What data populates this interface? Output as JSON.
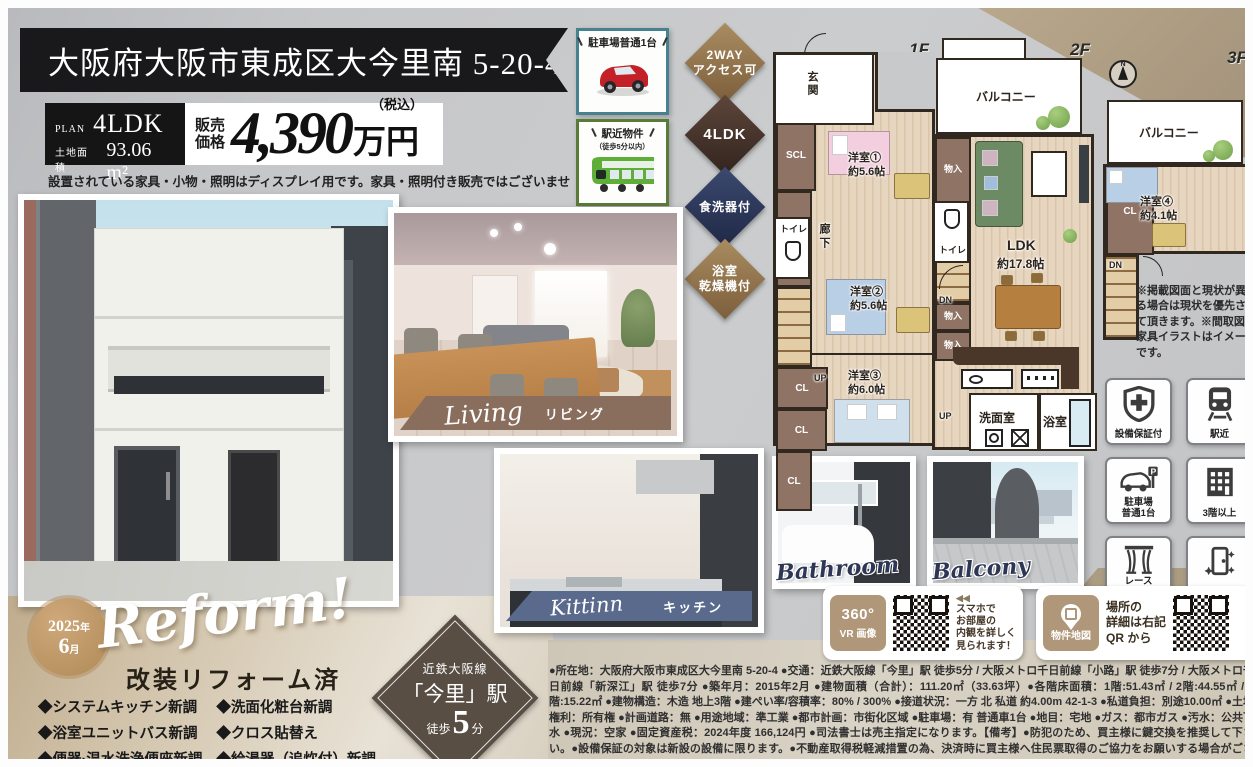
{
  "header": {
    "address": "大阪府大阪市東成区大今里南 5-20-4"
  },
  "plan_box": {
    "plan_label": "PLAN",
    "plan_value": "4LDK",
    "area_label": "土地面積",
    "area_value": "93.06 m²"
  },
  "price_box": {
    "label_line1": "販売",
    "label_line2": "価格",
    "value": "4,390",
    "unit": "万円",
    "tax_note": "（税込）"
  },
  "disclaimer": "設置されている家具・小物・照明はディスプレイ用です。家具・照明付き販売ではございません。",
  "top_badges": {
    "parking": {
      "title": "駐車場普通1台"
    },
    "station": {
      "title": "駅近物件",
      "subtitle": "（徒歩5分以内）"
    }
  },
  "diamonds": {
    "d1": {
      "line1": "2WAY",
      "line2": "アクセス可"
    },
    "d2": {
      "line1": "4LDK"
    },
    "d3": {
      "line1": "食洗器付"
    },
    "d4": {
      "line1": "浴室",
      "line2": "乾燥機付"
    }
  },
  "photo_labels": {
    "living": {
      "en": "Living",
      "jp": "リビング"
    },
    "kitchen": {
      "en": "Kittinn",
      "jp": "キッチン"
    },
    "bathroom": {
      "en": "Bathroom"
    },
    "balcony": {
      "en": "Balcony"
    }
  },
  "floorplan": {
    "f1_label": "1F",
    "f2_label": "2F",
    "f3_label": "3F",
    "compass_n": "N",
    "rooms": {
      "genkan": "玄関",
      "getabako": "下駄箱",
      "scl": "SCL",
      "cl": "CL",
      "toilet": "トイレ",
      "rouka": "廊下",
      "monoire": "物入",
      "up": "UP",
      "dn": "DN",
      "balcony": "バルコニー",
      "y1": "洋室①",
      "y1_size": "約5.6帖",
      "y2": "洋室②",
      "y2_size": "約5.6帖",
      "y3": "洋室③",
      "y3_size": "約6.0帖",
      "y4": "洋室④",
      "y4_size": "約4.1帖",
      "ldk": "LDK",
      "ldk_size": "約17.8帖",
      "senmen": "洗面室",
      "bath": "浴室"
    },
    "note": "※掲載図面と現状が異なる場合は現状を優先させて頂きます。※間取図の家具イラストはイメージです。"
  },
  "feature_icons": {
    "warranty": "設備保証付",
    "near_station": "駅近",
    "parking_l1": "駐車場",
    "parking_l2": "普通1台",
    "floors": "3階以上",
    "curtain_l1": "レース",
    "curtain_l2": "カーテン付",
    "renovated": "改装済"
  },
  "reform": {
    "badge_year": "2025",
    "badge_year_suffix": "年",
    "badge_month": "6",
    "badge_month_suffix": "月",
    "script": "Reform!",
    "title": "改装リフォーム済",
    "col1": [
      "◆システムキッチン新調",
      "◆浴室ユニットバス新調",
      "◆便器·温水洗浄便座新調"
    ],
    "col2": [
      "◆洗面化粧台新調",
      "◆クロス貼替え",
      "◆給湯器（追炊付）新調"
    ]
  },
  "station_diamond": {
    "line": "近鉄大阪線",
    "station": "「今里」駅",
    "walk_prefix": "徒歩",
    "walk_num": "5",
    "walk_suffix": "分"
  },
  "vr": {
    "icon_text": "360°",
    "icon_label": "VR 画像",
    "arrows": "◀◀",
    "lines": [
      "スマホで",
      "お部屋の",
      "内観を詳しく",
      "見られます！"
    ]
  },
  "map": {
    "icon_label": "物件地図",
    "lines": [
      "場所の",
      "詳細は右記",
      "QR から"
    ]
  },
  "description": "●所在地：大阪府大阪市東成区大今里南 5-20-4 ●交通：近鉄大阪線「今里」駅 徒歩5分 / 大阪メトロ千日前線「小路」駅 徒歩7分 / 大阪メトロ千日前線「新深江」駅 徒歩7分 ●築年月：2015年2月 ●建物面積（合計）：111.20㎡（33.63坪）●各階床面積：1階:51.43㎡ / 2階:44.55㎡ / 3階:15.22㎡ ●建物構造：木造 地上3階 ●建ぺい率/容積率：80% / 300% ●接道状況：一方 北 私道 約4.00m 42-1-3 ●私道負担：別途10.00㎡ ●土地権利：所有権 ●計画道路：無 ●用途地域：準工業 ●都市計画：市街化区域 ●駐車場：有 普通車1台 ●地目：宅地 ●ガス：都市ガス ●汚水：公共下水 ●現況：空家 ●固定資産税：2024年度 166,124円 ●司法書士は売主指定になります。【備考】●防犯のため、買主様に鍵交換を推奨して下さい。●設備保証の対象は新設の設備に限ります。●不動産取得税軽減措置の為、決済時に買主様へ住民票取得のご協力をお願いする場合がございます。",
  "colors": {
    "accent_brown": "#8a6f52",
    "accent_navy": "#2e3a5c",
    "banner_black": "#19191b",
    "living_banner": "#8a6e5d",
    "kitchen_banner": "#5a6a8c",
    "parking_border": "#47818f",
    "station_border": "#5a7a3a"
  }
}
